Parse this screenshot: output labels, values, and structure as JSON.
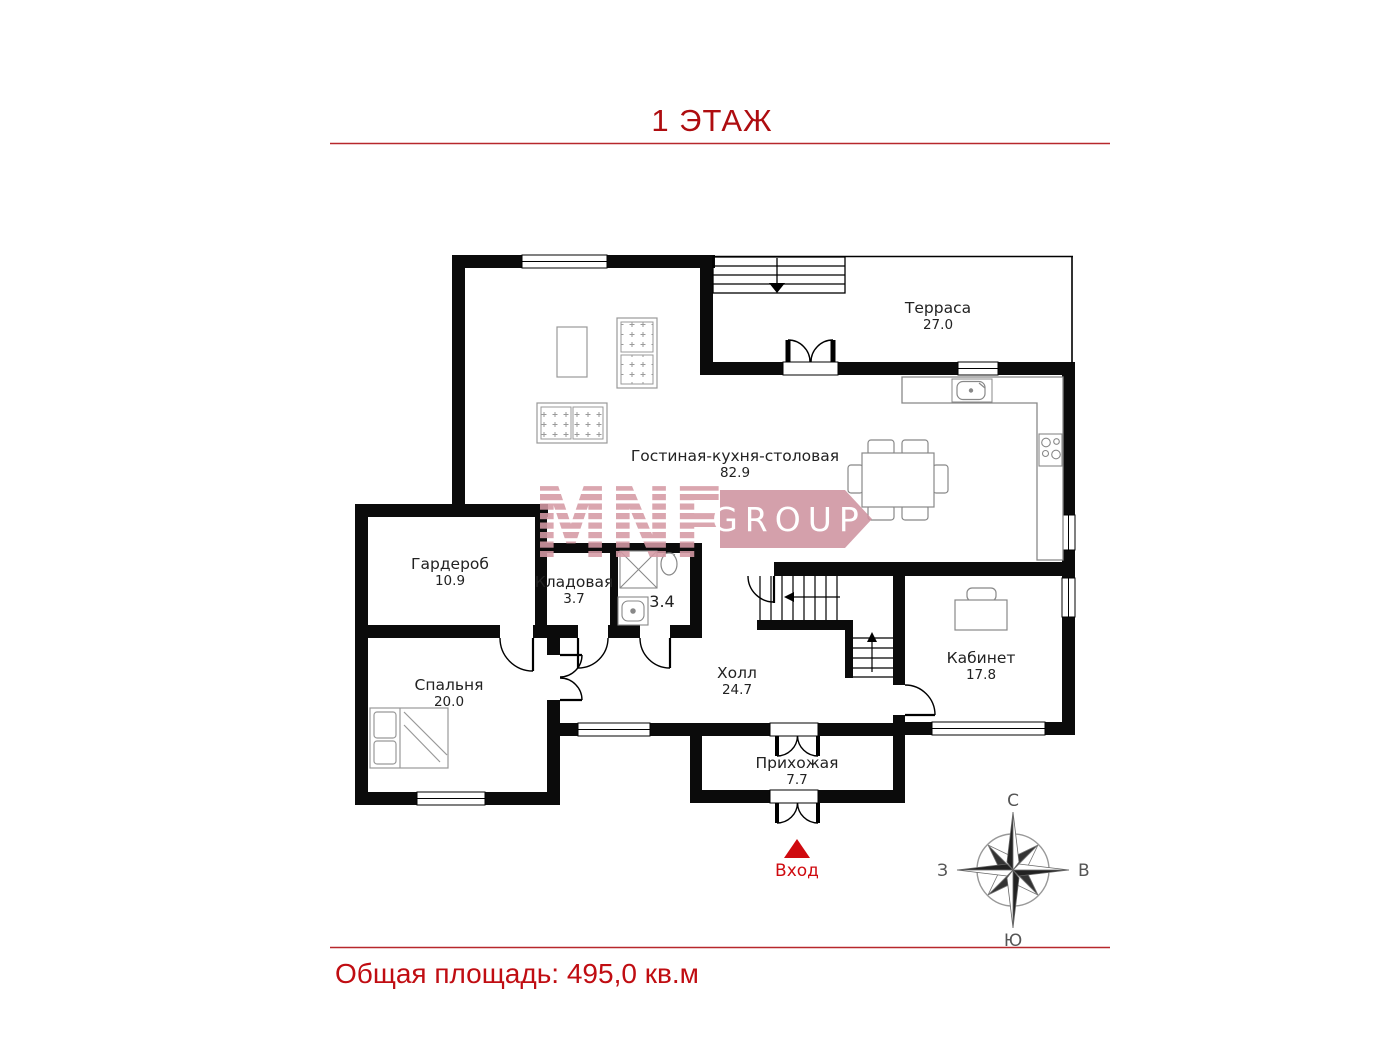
{
  "page": {
    "title": "1 ЭТАЖ",
    "footer": "Общая площадь: 495,0 кв.м",
    "entrance_label": "Вход",
    "accent_color": "#b00d10",
    "entrance_color": "#cf0a0f",
    "wall_color": "#0b0b0b",
    "watermark_color": "#d59aa5"
  },
  "rooms": [
    {
      "id": "terrace",
      "name": "Терраса",
      "area": "27.0"
    },
    {
      "id": "living",
      "name": "Гостиная-кухня-столовая",
      "area": "82.9"
    },
    {
      "id": "wardrobe",
      "name": "Гардероб",
      "area": "10.9"
    },
    {
      "id": "pantry",
      "name": "Кладовая",
      "area": "3.7"
    },
    {
      "id": "bathroom",
      "name": "",
      "area": "3.4"
    },
    {
      "id": "bedroom",
      "name": "Спальня",
      "area": "20.0"
    },
    {
      "id": "hall",
      "name": "Холл",
      "area": "24.7"
    },
    {
      "id": "office",
      "name": "Кабинет",
      "area": "17.8"
    },
    {
      "id": "entry",
      "name": "Прихожая",
      "area": "7.7"
    }
  ],
  "compass": {
    "north": "С",
    "south": "Ю",
    "west": "З",
    "east": "В"
  },
  "watermark": {
    "brand": "MNF",
    "suffix": "GROUP"
  }
}
